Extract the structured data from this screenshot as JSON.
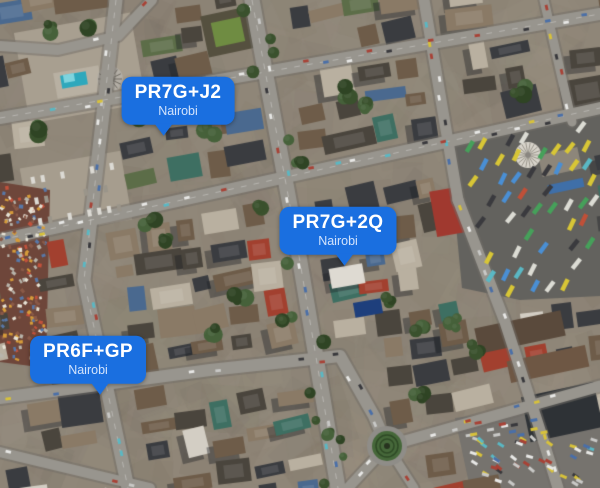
{
  "map": {
    "view": "satellite-imagery",
    "markers": [
      {
        "code": "PR7G+J2",
        "city": "Nairobi",
        "cx": 178,
        "tip_x": 164,
        "tip_y": 136
      },
      {
        "code": "PR7G+2Q",
        "city": "Nairobi",
        "cx": 338,
        "tip_x": 345,
        "tip_y": 266
      },
      {
        "code": "PR6F+GP",
        "city": "Nairobi",
        "cx": 88,
        "tip_x": 100,
        "tip_y": 395
      }
    ],
    "colors": {
      "marker_bg": "#1a6fe0",
      "marker_text": "#ffffff",
      "marker_subtext": "#d2e3fc"
    }
  }
}
